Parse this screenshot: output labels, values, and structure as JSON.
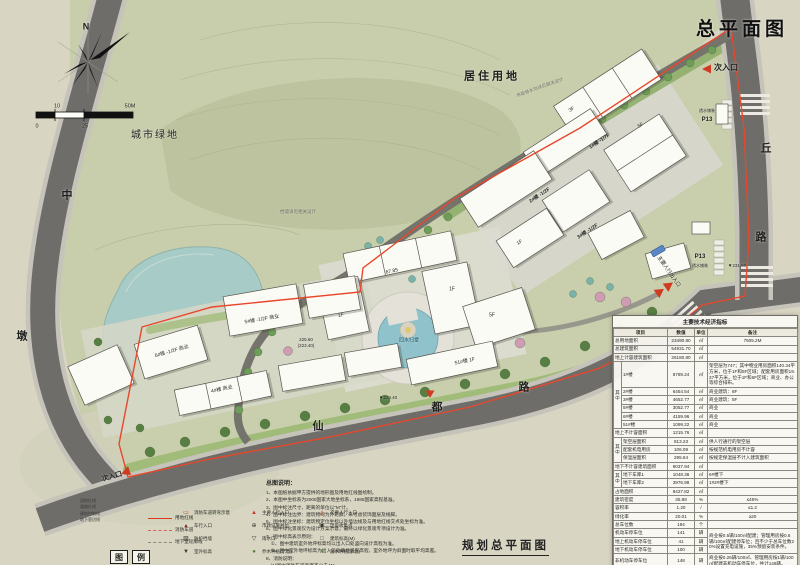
{
  "header": {
    "title": "总平面图",
    "compass_north": "N"
  },
  "footer": {
    "title": "规划总平面图"
  },
  "labels": [
    {
      "g": "compass-north-label",
      "t": "N",
      "x": 86,
      "y": 27,
      "s": 9,
      "b": 1
    },
    {
      "g": "scale-tick",
      "t": "0",
      "x": 37,
      "y": 127,
      "s": 5.5
    },
    {
      "g": "scale-tick",
      "t": "10",
      "x": 57,
      "y": 107,
      "s": 5.5
    },
    {
      "g": "scale-tick",
      "t": "25",
      "x": 85,
      "y": 127,
      "s": 5.5
    },
    {
      "g": "scale-tick",
      "t": "50M",
      "x": 130,
      "y": 107,
      "s": 5.5
    },
    {
      "g": "landuse-label",
      "t": "居住用地",
      "x": 492,
      "y": 77,
      "s": 11,
      "b": 1,
      "ls": 3
    },
    {
      "g": "landuse-label",
      "t": "城市绿地",
      "x": 155,
      "y": 136,
      "s": 10,
      "ls": 2
    },
    {
      "g": "road-name",
      "t": "中",
      "x": 67,
      "y": 196,
      "s": 11,
      "b": 1
    },
    {
      "g": "road-name",
      "t": "墩",
      "x": 22,
      "y": 337,
      "s": 11,
      "b": 1
    },
    {
      "g": "road-name",
      "t": "仙",
      "x": 318,
      "y": 427,
      "s": 11,
      "b": 1
    },
    {
      "g": "road-name",
      "t": "都",
      "x": 437,
      "y": 408,
      "s": 11,
      "b": 1
    },
    {
      "g": "road-name",
      "t": "路",
      "x": 524,
      "y": 388,
      "s": 11,
      "b": 1
    },
    {
      "g": "road-name",
      "t": "丘",
      "x": 766,
      "y": 149,
      "s": 11,
      "b": 1
    },
    {
      "g": "road-name",
      "t": "路",
      "x": 761,
      "y": 238,
      "s": 11,
      "b": 1
    },
    {
      "g": "entrance-label",
      "t": "次入口",
      "x": 726,
      "y": 68,
      "s": 8,
      "b": 1
    },
    {
      "g": "entrance-label",
      "t": "次入口",
      "x": 112,
      "y": 477,
      "s": 7,
      "b": 1,
      "r": -15
    },
    {
      "g": "entrance-label",
      "t": "主要人行出入口",
      "x": 668,
      "y": 272,
      "s": 5.2,
      "r": 55
    },
    {
      "g": "parking-label",
      "t": "透水铺装",
      "x": 707,
      "y": 111,
      "s": 4
    },
    {
      "g": "parking-label",
      "t": "P13",
      "x": 707,
      "y": 120,
      "s": 6,
      "b": 1
    },
    {
      "g": "parking-label",
      "t": "P13",
      "x": 700,
      "y": 257,
      "s": 6,
      "b": 1
    },
    {
      "g": "parking-label",
      "t": "透水铺装",
      "x": 700,
      "y": 266,
      "s": 4
    },
    {
      "g": "building-label",
      "t": "1#楼 -1/7F",
      "x": 600,
      "y": 142,
      "s": 5,
      "r": -33,
      "b": 1
    },
    {
      "g": "building-label",
      "t": "3F",
      "x": 572,
      "y": 110,
      "s": 5,
      "r": -33
    },
    {
      "g": "building-label",
      "t": "5F",
      "x": 641,
      "y": 126,
      "s": 5,
      "r": -33
    },
    {
      "g": "building-label",
      "t": "2#楼 -1/2F",
      "x": 540,
      "y": 196,
      "s": 5,
      "r": -33,
      "b": 1
    },
    {
      "g": "building-label",
      "t": "3#楼 -1/2F",
      "x": 588,
      "y": 232,
      "s": 5,
      "r": -33,
      "b": 1
    },
    {
      "g": "building-label",
      "t": "1F",
      "x": 520,
      "y": 243,
      "s": 5,
      "r": -33
    },
    {
      "g": "building-label",
      "t": "67.85",
      "x": 392,
      "y": 272,
      "s": 5,
      "r": -12
    },
    {
      "g": "building-label",
      "t": "1F",
      "x": 452,
      "y": 290,
      "s": 5
    },
    {
      "g": "building-label",
      "t": "5F",
      "x": 492,
      "y": 316,
      "s": 5
    },
    {
      "g": "water-feature-label",
      "t": "四水归堂",
      "x": 409,
      "y": 341,
      "s": 5,
      "c": "#1c4e5e"
    },
    {
      "g": "building-label",
      "t": "1F",
      "x": 341,
      "y": 316,
      "s": 5,
      "r": -12
    },
    {
      "g": "building-label",
      "t": "51#楼 1F",
      "x": 465,
      "y": 362,
      "s": 5,
      "r": -12
    },
    {
      "g": "building-label",
      "t": "5#楼 -1/2F 商业",
      "x": 262,
      "y": 320,
      "s": 5,
      "r": -10
    },
    {
      "g": "building-label",
      "t": "6#楼 -1/2F 商业",
      "x": 172,
      "y": 352,
      "s": 5,
      "r": -16
    },
    {
      "g": "building-label",
      "t": "4#楼 商业",
      "x": 222,
      "y": 390,
      "s": 5,
      "r": -12
    },
    {
      "g": "elevation-label",
      "t": "225.60",
      "x": 306,
      "y": 340,
      "s": 4.5
    },
    {
      "g": "elevation-label",
      "t": "(223.40)",
      "x": 306,
      "y": 346,
      "s": 4.5
    },
    {
      "g": "elevation-label",
      "t": "▼231.50",
      "x": 737,
      "y": 266,
      "s": 4.5
    },
    {
      "g": "elevation-label",
      "t": "▼223.40",
      "x": 388,
      "y": 398,
      "s": 4.5
    },
    {
      "g": "annotation-label",
      "t": "挡墙详见相关设计",
      "x": 298,
      "y": 212,
      "s": 4.5,
      "c": "#6b6b5e"
    },
    {
      "g": "annotation-label",
      "t": "市政排水沟详见相关设计",
      "x": 540,
      "y": 88,
      "s": 4.5,
      "c": "#6b6b5e",
      "r": -20
    }
  ],
  "notes": {
    "title": "总图说明：",
    "lines": [
      "1、本图纸依据甲方提供的地形图及用地红线图绘制。",
      "2、本图中坐标系为2000国家大地坐标系，1985国家高程基准。",
      "3、图中标注尺寸、距离的单位以\"M\"计。",
      "4、图中标注边界：建筑物均为外轮廓，未考虑装饰面层及线脚。",
      "5、图中标注坐标：建筑物定位坐标以外墙边线及与用地红线交点处坐标为准。",
      "6、图中绿化景观仅为设计方案示意，最终以绿化景观专项设计为准。",
      "7、图中标高表示原则：",
      "　①、图中建筑室外地坪标高均以出入口处竖向设计高程为准。",
      "　②、图中室外地坪标高为出入口处场地竖向高程，室外地坪为斜面时取平均高差。",
      "8、消防说明：",
      "　(1)图中消防车道宽度不小于4M。",
      "　(2)图中高度24米以上建筑的消防车道转弯半径不小于9M。"
    ]
  },
  "legend": {
    "box_chars": [
      "图",
      "例"
    ],
    "stack": [
      "用地红线",
      "道路红线",
      "建筑控制线",
      "地下室边线"
    ],
    "line_items": [
      {
        "style": "sw-solid",
        "label": "用地红线"
      },
      {
        "style": "sw-dash",
        "label": "消防车道"
      },
      {
        "style": "sw-gray",
        "label": "地下室轮廓线"
      }
    ],
    "symbol_items": [
      {
        "glyph": "▭",
        "color": "#c23a22",
        "label": "消防车道转弯示意"
      },
      {
        "glyph": "▲",
        "color": "#c23a22",
        "label": "主要人行入口"
      },
      {
        "glyph": "△",
        "color": "#c23a22",
        "label": "次要人行入口"
      },
      {
        "glyph": "▴",
        "color": "#8c1f12",
        "label": "车行入口"
      },
      {
        "glyph": "⊕",
        "color": "#3a3a34",
        "label": "市政设施井位"
      },
      {
        "glyph": "▣",
        "color": "#3a3a34",
        "label": "垃圾收集点"
      },
      {
        "glyph": "▨",
        "color": "#3a3a34",
        "label": "防护挡墙"
      },
      {
        "glyph": "▽",
        "color": "#3a3a34",
        "label": "雨水口"
      },
      {
        "glyph": "□",
        "color": "#3a3a34",
        "label": "建筑标高(M)"
      },
      {
        "glyph": "▼",
        "color": "#3a3a34",
        "label": "室外标高"
      },
      {
        "glyph": "●",
        "color": "#5a7f3f",
        "label": "乔木种植(示意)"
      },
      {
        "glyph": "∗",
        "color": "#5a7f3f",
        "label": "灌木种植(示意)"
      }
    ]
  },
  "table": {
    "title": "主要技术经济指标",
    "rows": [
      [
        {
          "t": "项目",
          "cs": 2
        },
        {
          "t": "数值"
        },
        {
          "t": "单位"
        },
        {
          "t": "备注"
        }
      ],
      [
        {
          "t": "总用地面积",
          "cs": 2,
          "al": "l"
        },
        {
          "t": "23490.80"
        },
        {
          "t": "㎡"
        },
        {
          "t": "7505.2M"
        }
      ],
      [
        {
          "t": "总建筑面积",
          "cs": 2,
          "al": "l"
        },
        {
          "t": "54931.70"
        },
        {
          "t": "㎡"
        },
        {
          "t": ""
        }
      ],
      [
        {
          "t": "地上计容建筑面积",
          "cs": 2,
          "al": "l"
        },
        {
          "t": "26180.80"
        },
        {
          "t": "㎡"
        },
        {
          "t": ""
        }
      ],
      [
        {
          "t": "其中",
          "rs": 6,
          "v": 1
        },
        {
          "t": "1#楼",
          "al": "l"
        },
        {
          "t": "8789.24"
        },
        {
          "t": "㎡"
        },
        {
          "t": "架空层为747；其中物业用房面积140.34平方米，位于1F和5F区域；配套用房面积19.37平方米，位于1F和6F区域；商业、办公等综合排布。",
          "al": "l"
        }
      ],
      [
        {
          "t": "2#楼",
          "al": "l"
        },
        {
          "t": "6454.54"
        },
        {
          "t": "㎡"
        },
        {
          "t": "商业建筑：8F",
          "al": "l"
        }
      ],
      [
        {
          "t": "3#楼",
          "al": "l"
        },
        {
          "t": "4652.77"
        },
        {
          "t": "㎡"
        },
        {
          "t": "商业建筑：5F",
          "al": "l"
        }
      ],
      [
        {
          "t": "5#楼",
          "al": "l"
        },
        {
          "t": "3052.77"
        },
        {
          "t": "㎡"
        },
        {
          "t": "商业",
          "al": "l"
        }
      ],
      [
        {
          "t": "6#楼",
          "al": "l"
        },
        {
          "t": "4159.96"
        },
        {
          "t": "㎡"
        },
        {
          "t": "商业",
          "al": "l"
        }
      ],
      [
        {
          "t": "51#楼",
          "al": "l"
        },
        {
          "t": "1099.22"
        },
        {
          "t": "㎡"
        },
        {
          "t": "商业",
          "al": "l"
        }
      ],
      [
        {
          "t": "地上不计容面积",
          "cs": 2,
          "al": "l"
        },
        {
          "t": "1215.76"
        },
        {
          "t": "㎡"
        },
        {
          "t": ""
        }
      ],
      [
        {
          "t": "其中",
          "rs": 3,
          "v": 1
        },
        {
          "t": "架空层面积",
          "al": "l"
        },
        {
          "t": "813.23"
        },
        {
          "t": "㎡"
        },
        {
          "t": "供人行通行的架空层",
          "al": "l"
        }
      ],
      [
        {
          "t": "配套机电用房",
          "al": "l"
        },
        {
          "t": "106.09"
        },
        {
          "t": "㎡"
        },
        {
          "t": "按规范机电用房不计容",
          "al": "l"
        }
      ],
      [
        {
          "t": "保温层面积",
          "al": "l"
        },
        {
          "t": "295.64"
        },
        {
          "t": "㎡"
        },
        {
          "t": "按规定保温层不计入建筑面积",
          "al": "l"
        }
      ],
      [
        {
          "t": "地下不计容建筑面积",
          "cs": 2,
          "al": "l"
        },
        {
          "t": "9037.94"
        },
        {
          "t": "㎡"
        },
        {
          "t": ""
        }
      ],
      [
        {
          "t": "其中",
          "rs": 2,
          "v": 1
        },
        {
          "t": "地下车库1",
          "al": "l"
        },
        {
          "t": "1048.36"
        },
        {
          "t": "㎡"
        },
        {
          "t": "6#楼下",
          "al": "l"
        }
      ],
      [
        {
          "t": "地下车库2",
          "al": "l"
        },
        {
          "t": "3976.98"
        },
        {
          "t": "㎡"
        },
        {
          "t": "1#2#楼下",
          "al": "l"
        }
      ],
      [
        {
          "t": "占地面积",
          "cs": 2,
          "al": "l"
        },
        {
          "t": "8427.82"
        },
        {
          "t": "㎡"
        },
        {
          "t": ""
        }
      ],
      [
        {
          "t": "建筑密度",
          "cs": 2,
          "al": "l"
        },
        {
          "t": "35.88"
        },
        {
          "t": "%"
        },
        {
          "t": "≤45%"
        }
      ],
      [
        {
          "t": "容积率",
          "cs": 2,
          "al": "l"
        },
        {
          "t": "1.20"
        },
        {
          "t": "/"
        },
        {
          "t": "≤1.2"
        }
      ],
      [
        {
          "t": "绿化率",
          "cs": 2,
          "al": "l"
        },
        {
          "t": "20.01"
        },
        {
          "t": "%"
        },
        {
          "t": "≥20"
        }
      ],
      [
        {
          "t": "总车位数",
          "cs": 2,
          "al": "l"
        },
        {
          "t": "194"
        },
        {
          "t": "个"
        },
        {
          "t": ""
        }
      ],
      [
        {
          "t": "机动车停车位",
          "cs": 2,
          "al": "l"
        },
        {
          "t": "141"
        },
        {
          "t": "辆"
        },
        {
          "t": "商业按0.5辆/100㎡配建；管理用房按0.6辆/100㎡配建停车位；且不少于总车位数20%设置充电设施，35%预留安装条件。",
          "rs": 3,
          "al": "l"
        }
      ],
      [
        {
          "t": "地上机动车停车位",
          "cs": 2,
          "al": "l"
        },
        {
          "t": "41"
        },
        {
          "t": "辆"
        }
      ],
      [
        {
          "t": "地下机动车停车位",
          "cs": 2,
          "al": "l"
        },
        {
          "t": "100"
        },
        {
          "t": "辆"
        }
      ],
      [
        {
          "t": "非机动车停车位",
          "cs": 2,
          "al": "l"
        },
        {
          "t": "148"
        },
        {
          "t": "辆"
        },
        {
          "t": "商业按0.26辆/100㎡、管理用房按1辆/100㎡配建非机动车停车位，共计148辆。",
          "al": "l"
        }
      ]
    ]
  }
}
